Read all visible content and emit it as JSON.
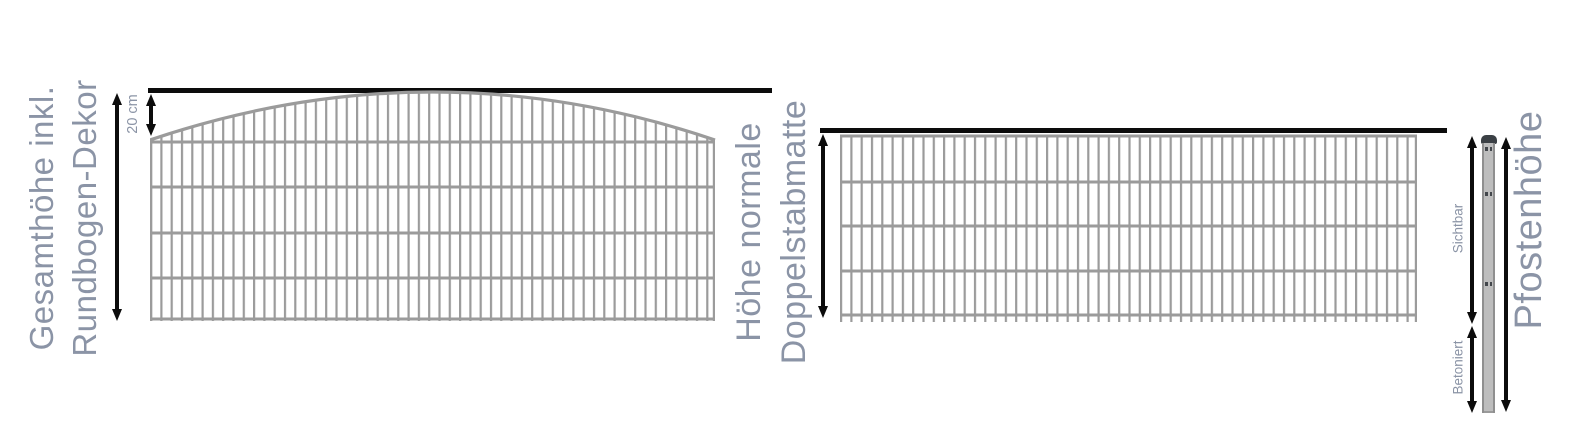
{
  "diagram_title": "fence-height-measurement-diagram",
  "left_panel": {
    "label_line1": "Gesamthöhe inkl.",
    "label_line2": "Rundbogen-Dekor",
    "arch_dimension_label": "20 cm"
  },
  "right_panel": {
    "label_line1": "Höhe normale",
    "label_line2": "Doppelstabmatte"
  },
  "post": {
    "visible_label": "Sichtbar",
    "concreted_label": "Betoniert",
    "height_label": "Pfostenhöhe"
  },
  "colors": {
    "label_text": "#8b94a6",
    "fence_gray": "#9b9b9b",
    "dimension_black": "#0c0c0c",
    "post_body": "#bdbdbd",
    "post_edge": "#8f8f8f",
    "post_cap": "#3b4045"
  }
}
